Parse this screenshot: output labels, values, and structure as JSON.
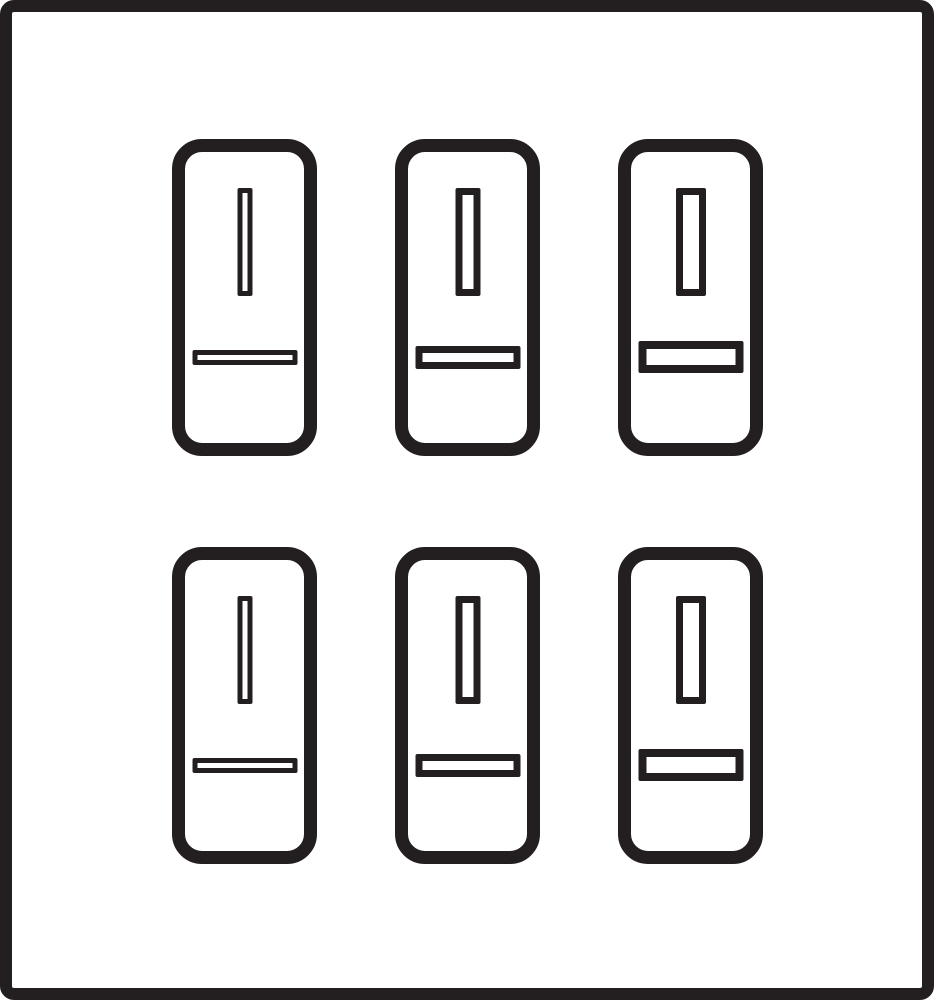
{
  "figure": {
    "title": "Six outlined refrigerator pictograms in a framed 2x3 grid",
    "rows": 2,
    "columns": 3,
    "colors": {
      "ink": "#231f20",
      "background": "#ffffff"
    },
    "frame": {
      "shape": "square-outline",
      "border_px": 12
    },
    "cards": [
      {
        "id": "card-1",
        "row": 1,
        "col": 1,
        "icon": "refrigerator-icon",
        "variant": "slim"
      },
      {
        "id": "card-2",
        "row": 1,
        "col": 2,
        "icon": "refrigerator-icon",
        "variant": "medium"
      },
      {
        "id": "card-3",
        "row": 1,
        "col": 3,
        "icon": "refrigerator-icon",
        "variant": "bold"
      },
      {
        "id": "card-4",
        "row": 2,
        "col": 1,
        "icon": "refrigerator-icon",
        "variant": "slim"
      },
      {
        "id": "card-5",
        "row": 2,
        "col": 2,
        "icon": "refrigerator-icon",
        "variant": "medium"
      },
      {
        "id": "card-6",
        "row": 2,
        "col": 3,
        "icon": "refrigerator-icon",
        "variant": "bold"
      }
    ],
    "card_parts": {
      "vertical_bar": "door-handle-bar",
      "horizontal_bar": "drawer-handle-bar"
    }
  }
}
